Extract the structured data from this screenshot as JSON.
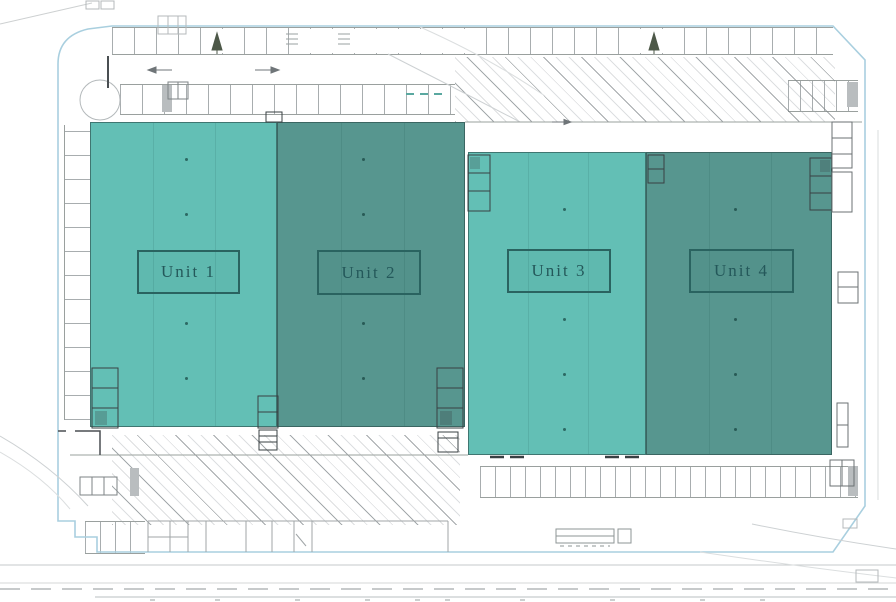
{
  "units": [
    {
      "label": "Unit 1",
      "fill": "#63bfb5"
    },
    {
      "label": "Unit 2",
      "fill": "#57968f"
    },
    {
      "label": "Unit 3",
      "fill": "#63bfb5"
    },
    {
      "label": "Unit 4",
      "fill": "#57968f"
    }
  ],
  "colors": {
    "unit_light": "#63bfb5",
    "unit_dark": "#57968f",
    "unit_label_text": "#24585a",
    "unit_label_border": "#2a6360",
    "site_boundary_line": "#a9cfdf",
    "drawing_line_gray": "#a6abad",
    "detail_line_dark": "#3c4346"
  }
}
